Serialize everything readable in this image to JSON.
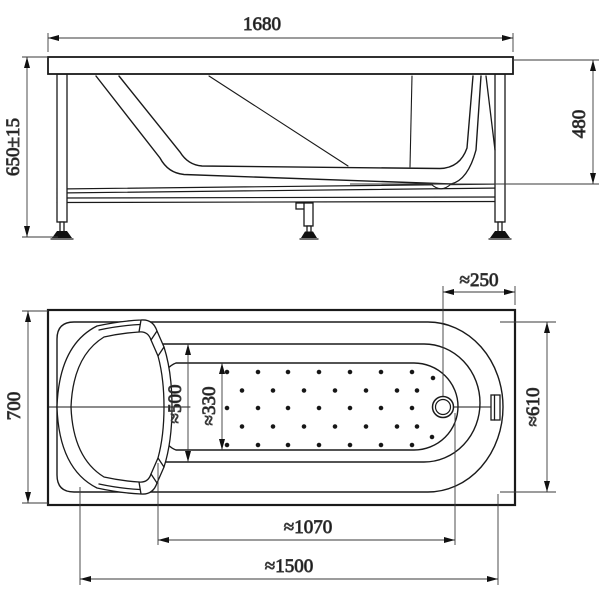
{
  "drawing": {
    "subject": "bathtub installation technical drawing",
    "views": {
      "side": "side elevation with support frame",
      "plan": "top plan view"
    }
  },
  "dimensions": {
    "overall_length": "1680",
    "overall_height": "650±15",
    "inner_depth": "480",
    "overall_width": "700",
    "drain_offset": "≈250",
    "rim_inner_width": "≈500",
    "floor_width": "≈330",
    "right_inner_width": "≈610",
    "floor_length": "≈1070",
    "shell_length": "≈1500"
  },
  "anti_slip_dots": {
    "radius": 1.8,
    "color": "#151515",
    "rows": [
      {
        "y": 372,
        "xs": [
          227,
          258,
          288,
          319,
          350,
          381,
          412
        ]
      },
      {
        "y": 390.5,
        "xs": [
          242,
          273,
          304,
          335,
          366,
          397,
          417
        ]
      },
      {
        "y": 408,
        "xs": [
          227,
          258,
          288,
          319,
          350,
          381,
          412
        ]
      },
      {
        "y": 426.5,
        "xs": [
          242,
          273,
          304,
          335,
          366,
          397,
          417
        ]
      },
      {
        "y": 445,
        "xs": [
          227,
          258,
          288,
          319,
          350,
          381,
          412
        ]
      }
    ],
    "extra": [
      [
        433,
        378
      ],
      [
        432,
        437
      ]
    ]
  },
  "colors": {
    "line": "#1a1a1a",
    "dim_line": "#3a3a3a",
    "background": "#ffffff"
  }
}
